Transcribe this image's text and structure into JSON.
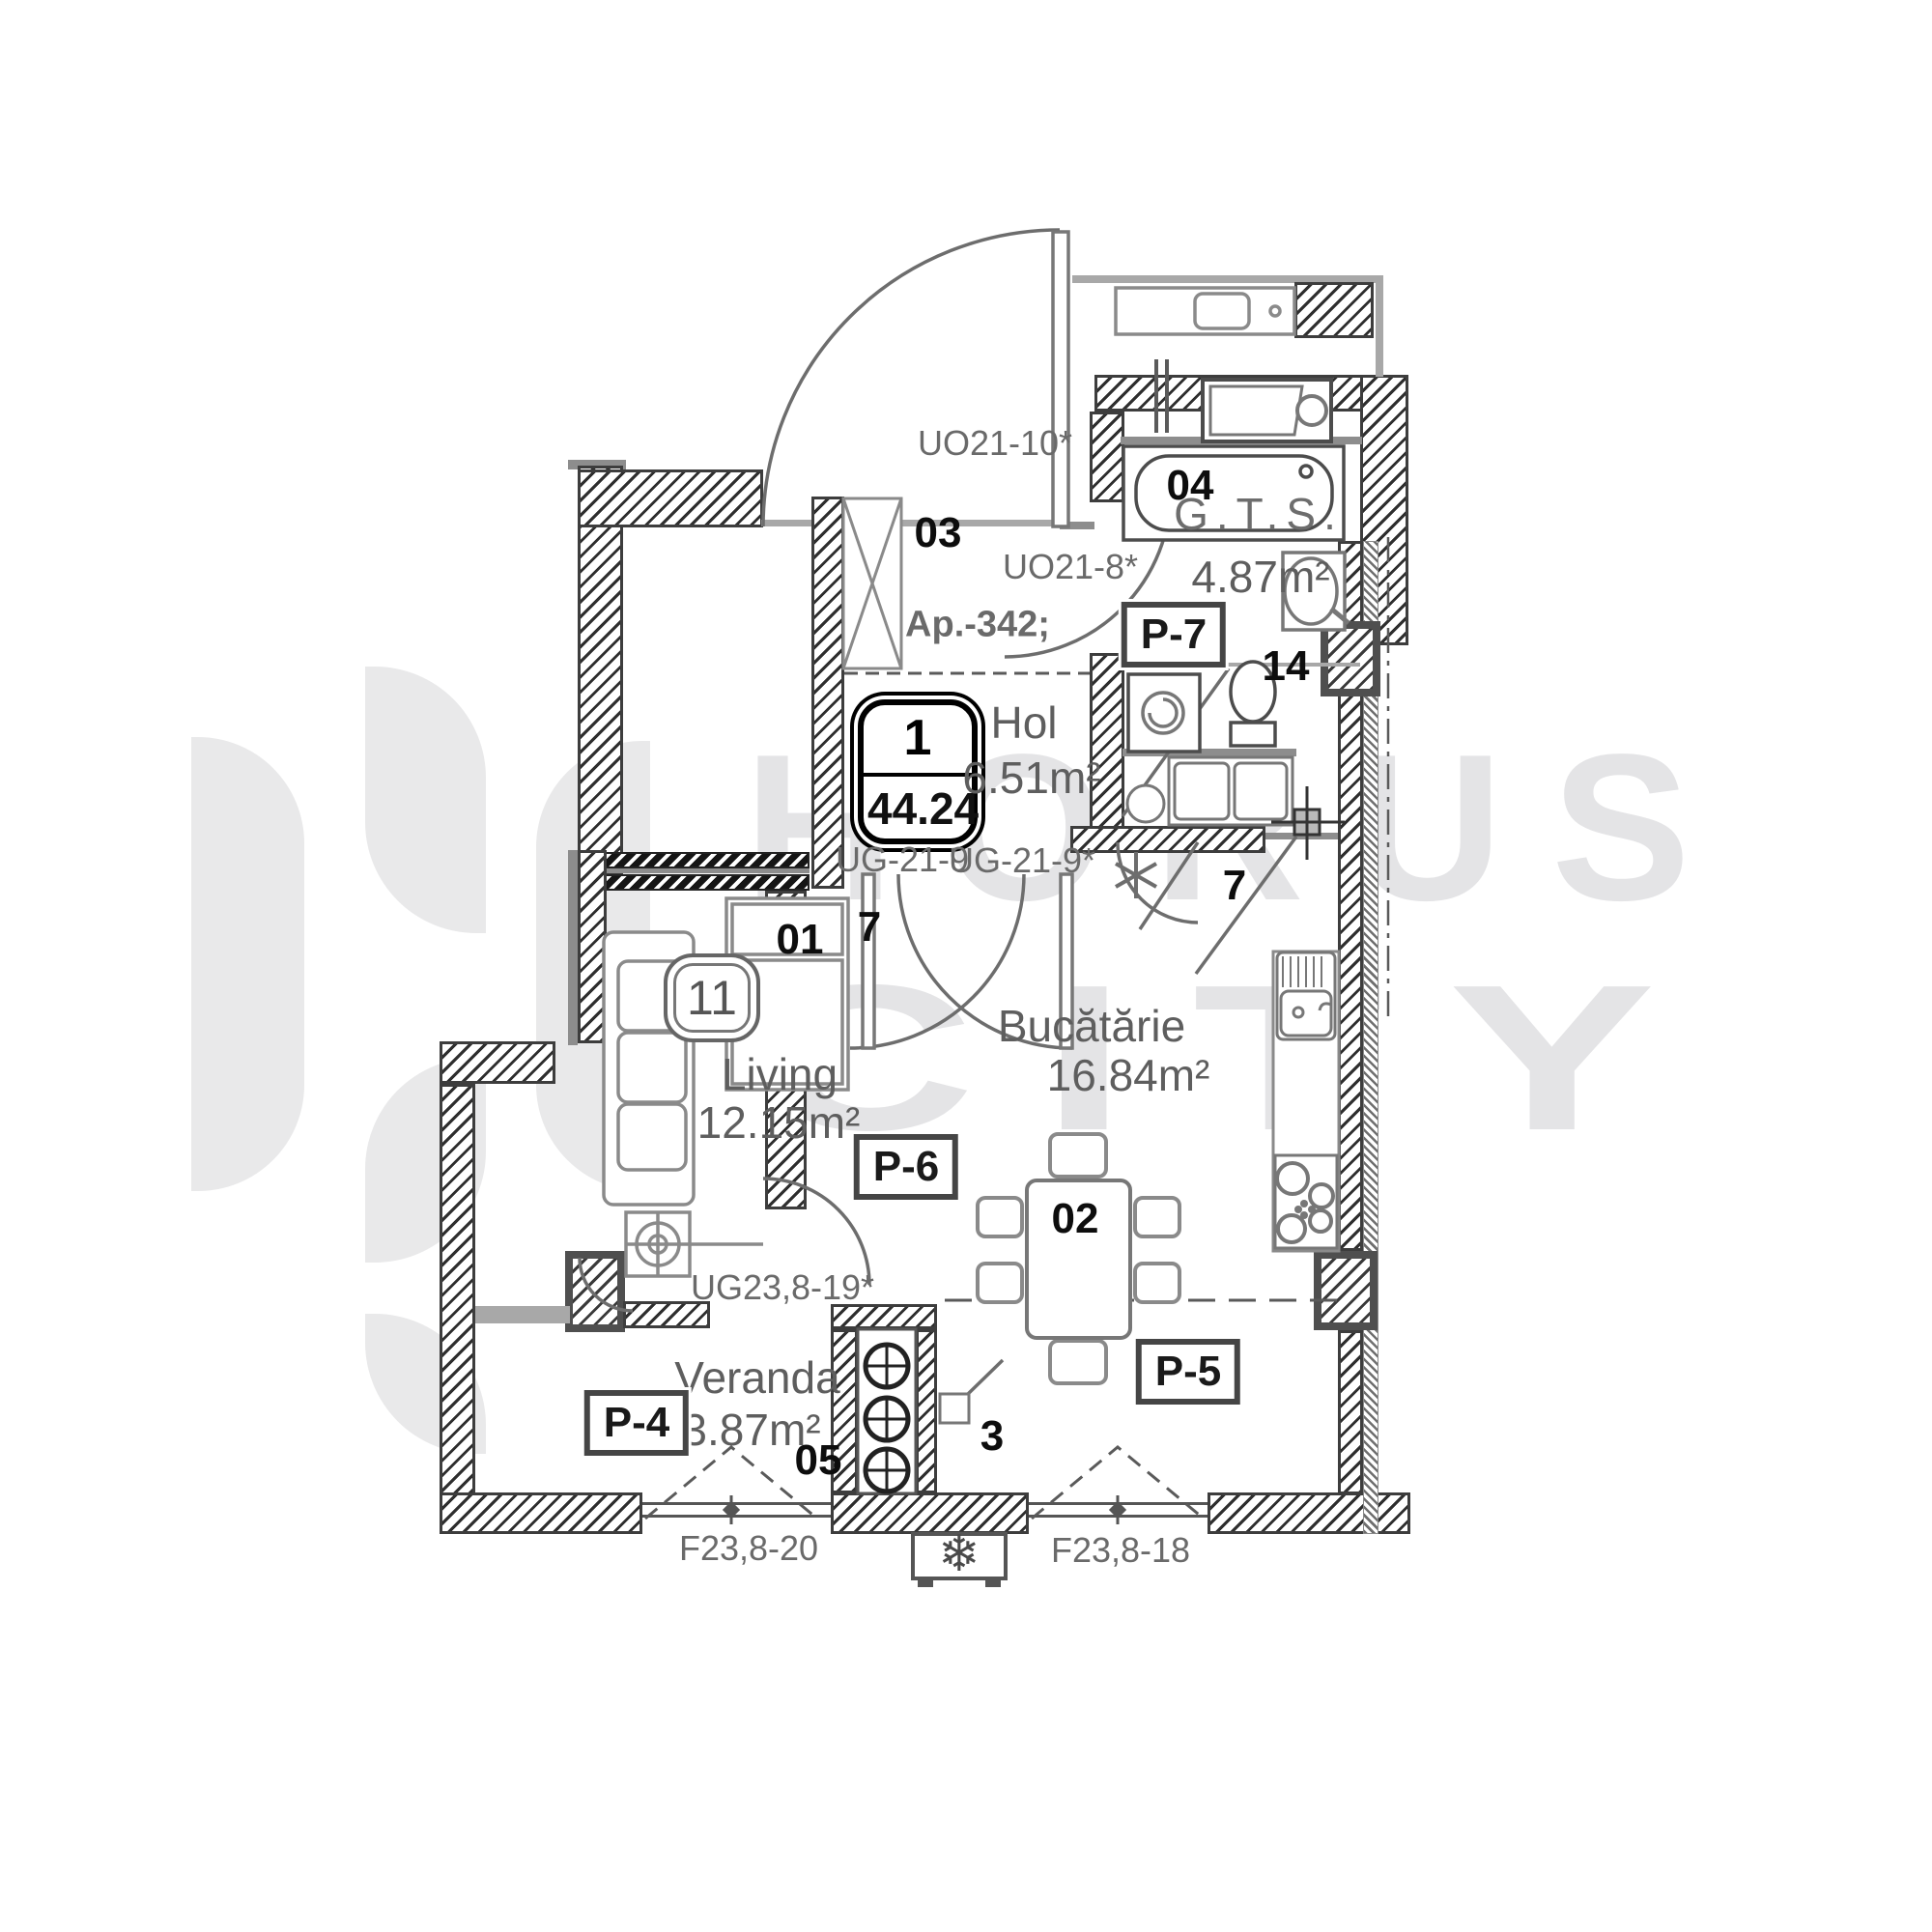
{
  "watermark": {
    "brand_line1": "HORUS",
    "brand_line2": "CITY"
  },
  "apartment": {
    "badge_number": "1",
    "badge_area": "44.24",
    "reference": "Ap.-342;",
    "furniture_badge": "11"
  },
  "rooms": {
    "room1_num": "01",
    "room1_name": "Living",
    "room1_area": "12.15m²",
    "room2_num": "02",
    "room2_name": "Bucătărie",
    "room2_area": "16.84m²",
    "room3_num": "03",
    "room4_num": "04",
    "room4_name": "G.T.S.",
    "room4_area": "4.87m²",
    "room5_num": "05",
    "room5_name": "Veranda",
    "room5_area": "3.87m²",
    "hol_name": "Hol",
    "hol_area": "6.51m²",
    "wc_num": "14"
  },
  "doors": {
    "entry": "UO21-10*",
    "bath": "UO21-8*",
    "living": "UG-21-9",
    "kitchen": "UG-21-9*",
    "veranda": "UG23,8-19*",
    "living_num": "7",
    "kitchen_num": "7",
    "veranda_num": "3"
  },
  "windows": {
    "veranda": "F23,8-20",
    "kitchen": "F23,8-18"
  },
  "panels": {
    "p4": "P-4",
    "p5": "P-5",
    "p6": "P-6",
    "p7": "P-7"
  },
  "colors": {
    "wall_ink": "#2e2e2e",
    "slab_gray": "#8d8d8d",
    "furniture_gray": "#8a8a8a",
    "text_gray": "#5e5e5e",
    "watermark_gray": "#e4e4e6"
  }
}
